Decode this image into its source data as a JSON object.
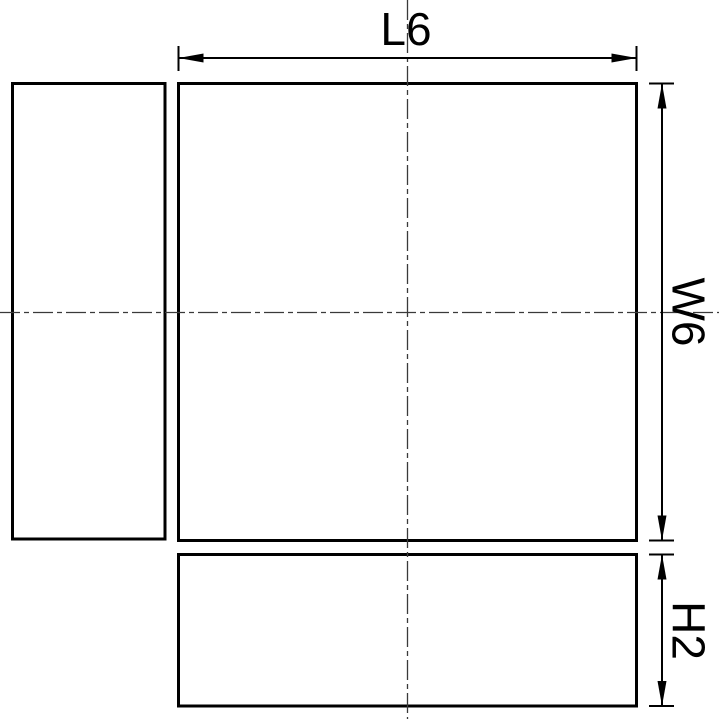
{
  "drawing": {
    "background_color": "#ffffff",
    "outline_color": "#000000",
    "dimension_color": "#000000",
    "centerline_color": "#3a3a3a",
    "dimensions": {
      "length": {
        "label": "L6",
        "letter": "L",
        "value": 6
      },
      "width": {
        "label": "W6",
        "letter": "W",
        "value": 6
      },
      "height": {
        "label": "H2",
        "letter": "H",
        "value": 2
      }
    }
  }
}
